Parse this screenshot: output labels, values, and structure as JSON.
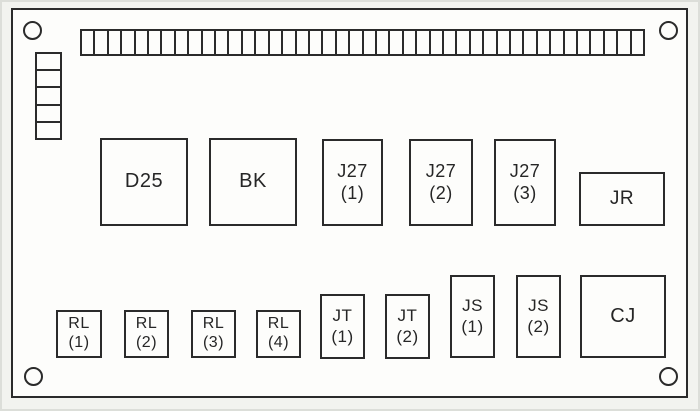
{
  "diagram": {
    "kind": "equipment-panel-component-layout",
    "colors": {
      "line": "#2b2b2b",
      "panel_background": "#fdfdfb",
      "page_background": "#f2f3ef"
    },
    "panel_outline": {
      "x": 11,
      "y": 8,
      "w": 677,
      "h": 390
    },
    "terminal_strip": {
      "segments": 42,
      "x": 80,
      "y": 29,
      "w": 565,
      "h": 27
    },
    "left_connector_stack": {
      "cells": 5,
      "x": 35,
      "y": 52,
      "w": 27,
      "h": 88
    },
    "mounting_holes": [
      {
        "cx": 32,
        "cy": 30
      },
      {
        "cx": 668,
        "cy": 30
      },
      {
        "cx": 33,
        "cy": 376
      },
      {
        "cx": 668,
        "cy": 376
      }
    ],
    "components": [
      {
        "id": "d25",
        "lines": [
          "D25"
        ],
        "x": 100,
        "y": 138,
        "w": 88,
        "h": 88,
        "fs": 20
      },
      {
        "id": "bk",
        "lines": [
          "BK"
        ],
        "x": 209,
        "y": 138,
        "w": 88,
        "h": 88,
        "fs": 20
      },
      {
        "id": "j27-1",
        "lines": [
          "J27",
          "(1)"
        ],
        "x": 322,
        "y": 139,
        "w": 61,
        "h": 87,
        "fs": 18
      },
      {
        "id": "j27-2",
        "lines": [
          "J27",
          "(2)"
        ],
        "x": 409,
        "y": 139,
        "w": 64,
        "h": 87,
        "fs": 18
      },
      {
        "id": "j27-3",
        "lines": [
          "J27",
          "(3)"
        ],
        "x": 494,
        "y": 139,
        "w": 62,
        "h": 87,
        "fs": 18
      },
      {
        "id": "jr",
        "lines": [
          "JR"
        ],
        "x": 579,
        "y": 172,
        "w": 86,
        "h": 54,
        "fs": 19
      },
      {
        "id": "rl-1",
        "lines": [
          "RL",
          "(1)"
        ],
        "x": 56,
        "y": 310,
        "w": 46,
        "h": 48,
        "fs": 16
      },
      {
        "id": "rl-2",
        "lines": [
          "RL",
          "(2)"
        ],
        "x": 124,
        "y": 310,
        "w": 45,
        "h": 48,
        "fs": 16
      },
      {
        "id": "rl-3",
        "lines": [
          "RL",
          "(3)"
        ],
        "x": 191,
        "y": 310,
        "w": 45,
        "h": 48,
        "fs": 16
      },
      {
        "id": "rl-4",
        "lines": [
          "RL",
          "(4)"
        ],
        "x": 256,
        "y": 310,
        "w": 45,
        "h": 48,
        "fs": 16
      },
      {
        "id": "jt-1",
        "lines": [
          "JT",
          "(1)"
        ],
        "x": 320,
        "y": 294,
        "w": 45,
        "h": 65,
        "fs": 17
      },
      {
        "id": "jt-2",
        "lines": [
          "JT",
          "(2)"
        ],
        "x": 385,
        "y": 294,
        "w": 45,
        "h": 65,
        "fs": 17
      },
      {
        "id": "js-1",
        "lines": [
          "JS",
          "(1)"
        ],
        "x": 450,
        "y": 275,
        "w": 45,
        "h": 83,
        "fs": 17
      },
      {
        "id": "js-2",
        "lines": [
          "JS",
          "(2)"
        ],
        "x": 516,
        "y": 275,
        "w": 45,
        "h": 83,
        "fs": 17
      },
      {
        "id": "cj",
        "lines": [
          "CJ"
        ],
        "x": 580,
        "y": 275,
        "w": 86,
        "h": 83,
        "fs": 20
      }
    ]
  }
}
